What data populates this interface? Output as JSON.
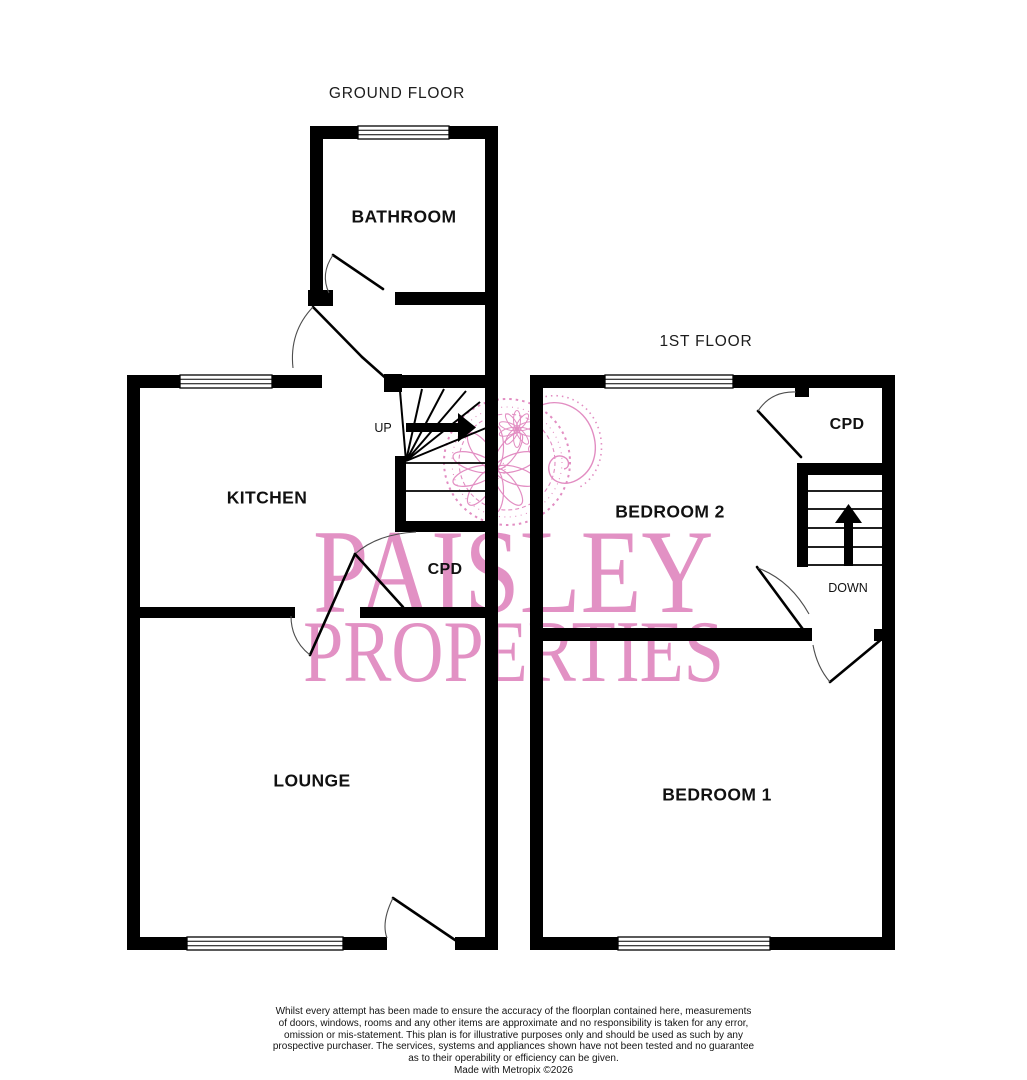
{
  "ground_floor": {
    "title": "GROUND FLOOR",
    "bathroom": "BATHROOM",
    "kitchen": "KITCHEN",
    "cupboard": "CPD",
    "lounge": "LOUNGE",
    "stair_direction": "UP"
  },
  "first_floor": {
    "title": "1ST FLOOR",
    "bedroom2": "BEDROOM 2",
    "cupboard": "CPD",
    "bedroom1": "BEDROOM 1",
    "stair_direction": "DOWN"
  },
  "watermark": {
    "name_line1": "PAISLEY",
    "name_line2": "PROPERTIES"
  },
  "disclaimer": {
    "lines": [
      "Whilst every attempt has been made to ensure the accuracy of the floorplan contained here, measurements",
      "of doors, windows, rooms and any other items are approximate and no responsibility is taken for any error,",
      "omission or mis-statement. This plan is for illustrative purposes only and should be used as such by any",
      "prospective purchaser. The services, systems and appliances shown have not been tested and no guarantee",
      "as to their operability or efficiency can be given."
    ],
    "credit": "Made with Metropix ©2026"
  },
  "colors": {
    "wall": "#000000",
    "watermark_text": "#e291c4",
    "watermark_ornament": "#dd7ab8",
    "label_text": "#111111"
  }
}
